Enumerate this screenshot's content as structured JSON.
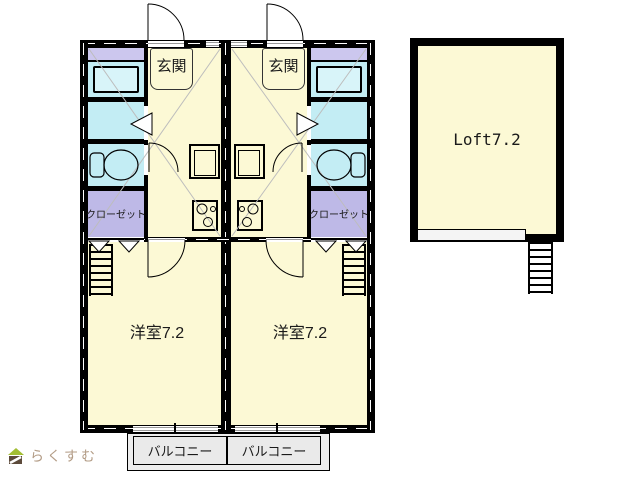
{
  "units": {
    "left": {
      "entrance": "玄関",
      "closet": "クローゼット",
      "room": "洋室7.2",
      "balcony": "バルコニー"
    },
    "right": {
      "entrance": "玄関",
      "closet": "クローゼット",
      "room": "洋室7.2",
      "balcony": "バルコニー"
    }
  },
  "loft": {
    "label": "Loft7.2"
  },
  "watermark": {
    "brand": "らくすむ"
  },
  "colors": {
    "wall": "#000000",
    "floor_cream": "#fcf9d5",
    "wet_cyan": "#c3edf4",
    "tub_cyan": "#d8f4f9",
    "closet_purple": "#beb9e7",
    "laundry_purple": "#ccc7ee",
    "balcony_gray": "#ededed",
    "diagonal_gray": "#bdbdbd",
    "watermark_text": "#b39c86",
    "roof_green": "#a2be33",
    "house_brown": "#5c4a3b"
  }
}
